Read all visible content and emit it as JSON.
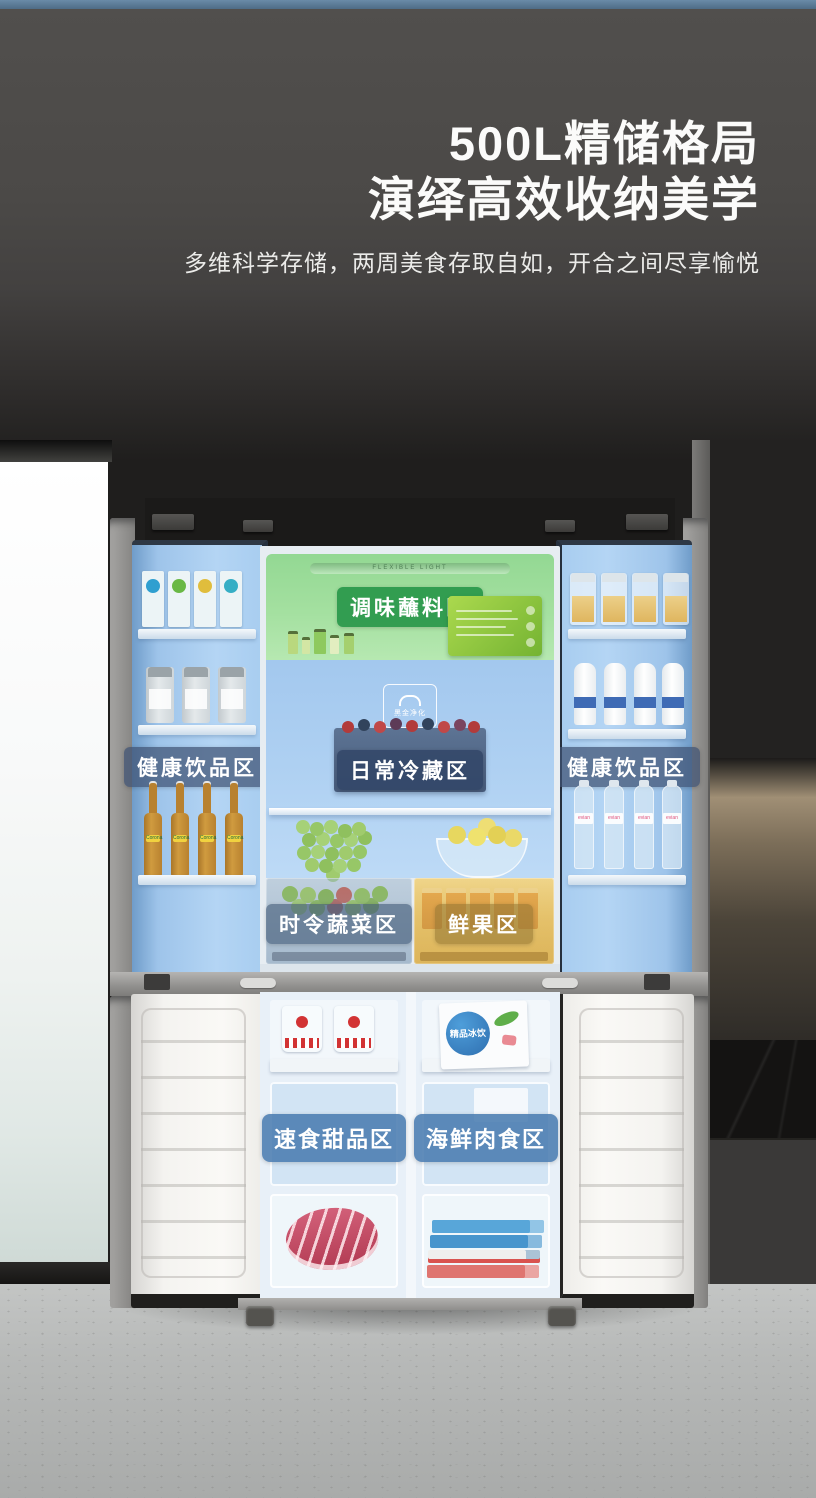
{
  "hero": {
    "title_line1": "500L精储格局",
    "title_line2": "演绎高效收纳美学",
    "subtitle": "多维科学存储，两周美食存取自如，开合之间尽享愉悦"
  },
  "fridge": {
    "light_label": "FLEXIBLE LIGHT",
    "purify_logo": "黑金净化",
    "freezer_card_label": "精品冰饮",
    "bottle_brand": "Corona",
    "water_brand": "evian",
    "zones": {
      "condiment": {
        "label": "调味蘸料区",
        "badge_color": "#2e9a50"
      },
      "left_door": {
        "label": "健康饮品区",
        "badge_color": "#3e5273"
      },
      "right_door": {
        "label": "健康饮品区",
        "badge_color": "#3e5273"
      },
      "daily": {
        "label": "日常冷藏区",
        "badge_color": "#324668"
      },
      "vegetable": {
        "label": "时令蔬菜区",
        "badge_color": "#425a78"
      },
      "fruit": {
        "label": "鲜果区",
        "badge_color": "#8f7232"
      },
      "dessert": {
        "label": "速食甜品区",
        "badge_color": "#4a7cb0"
      },
      "seafood": {
        "label": "海鲜肉食区",
        "badge_color": "#4a7cb0"
      }
    }
  },
  "colors": {
    "top_strip": "#5d7d9b",
    "wall": "#4b4947",
    "fridge_interior_blue": "#aed0f2",
    "condiment_zone_green": "#a4e0a0",
    "fruit_drawer_gold": "#e4bf63",
    "freezer_interior": "#e8f0f8",
    "floor": "#b7b9b8"
  }
}
